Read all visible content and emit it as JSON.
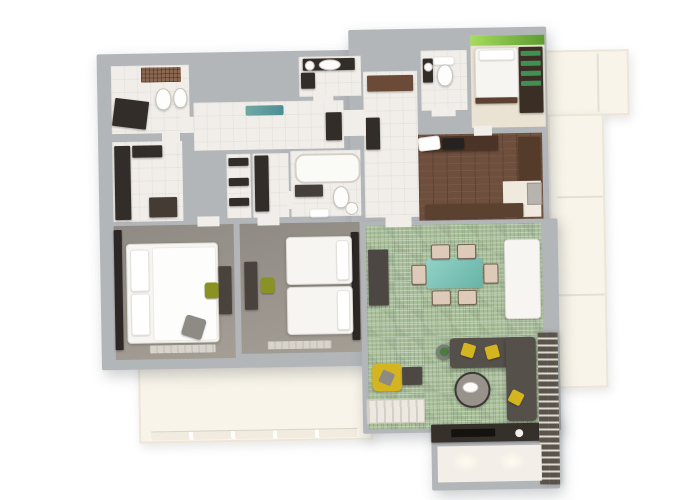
{
  "scene": {
    "description": "3D rendered top-down floor plan of a two/three-bedroom apartment, no text labels visible",
    "background": "#ffffff",
    "rooms": [
      "bathroom-ensuite",
      "walk-in-closet",
      "corridor",
      "linen-closet",
      "hall-nook",
      "family-bathroom",
      "guest-bathroom",
      "wc",
      "kids-bedroom",
      "entrance-hall",
      "kitchen",
      "dining-nook",
      "bedroom-1",
      "bedroom-2",
      "living-dining-room",
      "entry-vestibule",
      "balcony-bottom",
      "balcony-right"
    ]
  },
  "palette": {
    "wall": "#b3b6b9",
    "floor_tile": "#f1eee9",
    "carpet_gray": "#9a948c",
    "carpet_beige": "#eae3d3",
    "floor_wood": "#6e4e3c",
    "floor_green": "#a9bf9a",
    "balcony": "#f8f4e9",
    "entry_floor": "#efe9de",
    "white_furn": "#f6f5f2",
    "dark_furn": "#332d29",
    "brown_furn": "#5d4030",
    "cab_brown": "#6b4a38",
    "accent_green": "#8bc53f",
    "accent_green2": "#3f9051",
    "olive_chair": "#8a9224",
    "teal_table": "#7cc6ba",
    "teal_rug": "#6ea9a2",
    "chair_blush": "#decab9",
    "sofa_gray": "#56504a",
    "yellow": "#d4b520",
    "brick": "#aaa49a"
  }
}
